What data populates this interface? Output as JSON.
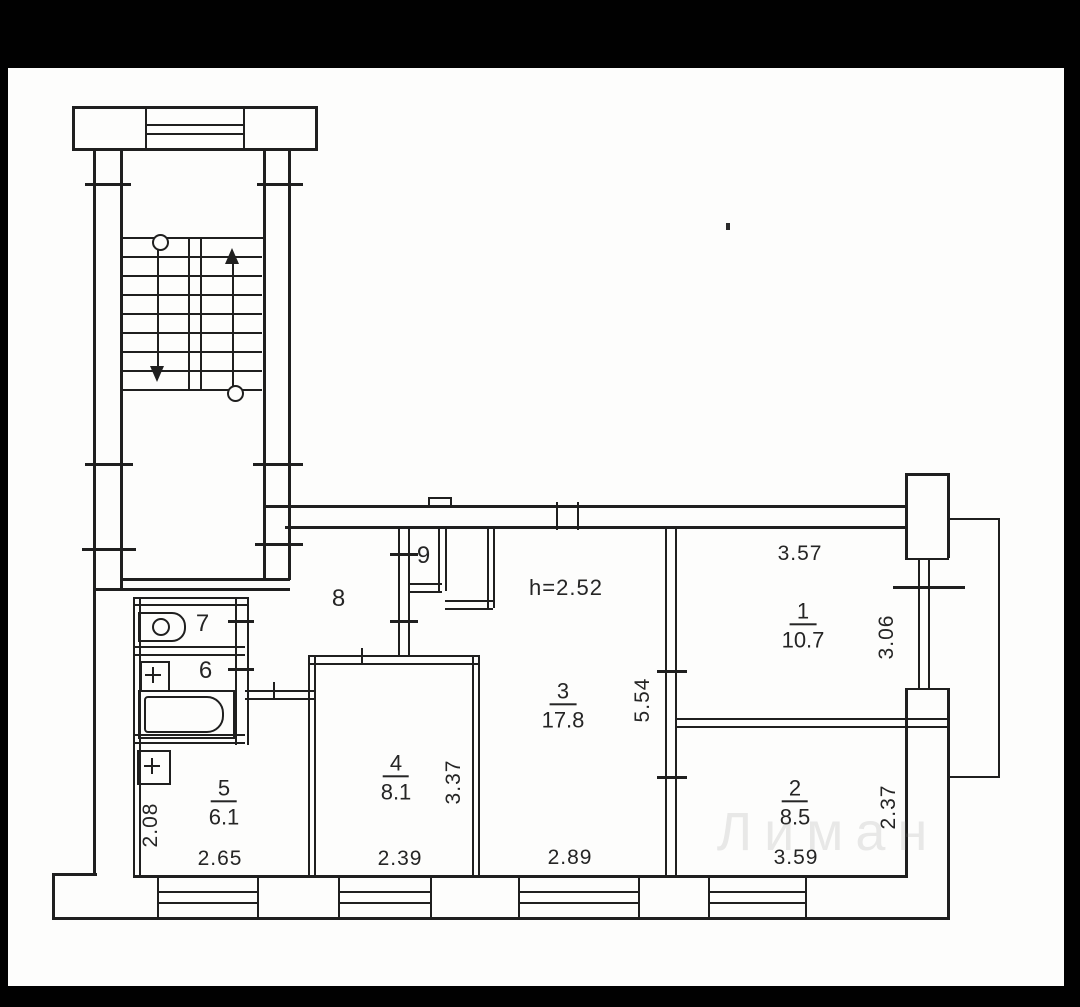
{
  "document": {
    "type": "scanned apartment floor plan",
    "paper_color": "#fdfdfc",
    "frame_color": "#010101",
    "ink_color": "#1f1f1f",
    "ceiling_height_note": "h=2.52",
    "watermark": {
      "text": "Лиман"
    }
  },
  "rooms": [
    {
      "number": "1",
      "area": "10.7",
      "width": "3.57",
      "depth": "3.06",
      "x": 803,
      "y": 626
    },
    {
      "number": "2",
      "area": "8.5",
      "width": "3.59",
      "depth": "2.37",
      "x": 795,
      "y": 803
    },
    {
      "number": "3",
      "area": "17.8",
      "width": "2.89",
      "depth": "5.54",
      "x": 563,
      "y": 706
    },
    {
      "number": "4",
      "area": "8.1",
      "width": "2.39",
      "depth": "3.37",
      "x": 396,
      "y": 778
    },
    {
      "number": "5",
      "area": "6.1",
      "width": "2.65",
      "depth": "2.08",
      "x": 224,
      "y": 803
    }
  ],
  "labels": {
    "dims": [
      {
        "text": "h=2.52",
        "x": 566,
        "y": 588,
        "s": 22
      },
      {
        "text": "3.57",
        "x": 800,
        "y": 554
      },
      {
        "text": "2.65",
        "x": 220,
        "y": 859
      },
      {
        "text": "2.39",
        "x": 400,
        "y": 859
      },
      {
        "text": "2.89",
        "x": 570,
        "y": 858
      },
      {
        "text": "3.59",
        "x": 796,
        "y": 858
      },
      {
        "text": "5.54",
        "x": 643,
        "y": 700,
        "r": 1
      },
      {
        "text": "3.37",
        "x": 454,
        "y": 782,
        "r": 1
      },
      {
        "text": "2.08",
        "x": 151,
        "y": 825,
        "r": 1
      },
      {
        "text": "3.06",
        "x": 887,
        "y": 637,
        "r": 1
      },
      {
        "text": "2.37",
        "x": 889,
        "y": 807,
        "r": 1
      },
      {
        "text": "6",
        "x": 206,
        "y": 671,
        "s": 24
      },
      {
        "text": "7",
        "x": 203,
        "y": 624,
        "s": 24
      },
      {
        "text": "8",
        "x": 339,
        "y": 599,
        "s": 24
      },
      {
        "text": "9",
        "x": 424,
        "y": 556,
        "s": 24
      }
    ]
  },
  "geometry": {
    "h_lines": [
      [
        72,
        106,
        246
      ],
      [
        72,
        148,
        246
      ],
      [
        145,
        124,
        98,
        2
      ],
      [
        145,
        133,
        98,
        2
      ],
      [
        120,
        237,
        143,
        2
      ],
      [
        122,
        389,
        140,
        2
      ],
      [
        120,
        578,
        170
      ],
      [
        93,
        588,
        197
      ],
      [
        263,
        505,
        645
      ],
      [
        285,
        526,
        622
      ],
      [
        133,
        597,
        116,
        2
      ],
      [
        133,
        604,
        116,
        2
      ],
      [
        133,
        646,
        112,
        2
      ],
      [
        133,
        654,
        112,
        2
      ],
      [
        133,
        734,
        112,
        2
      ],
      [
        133,
        742,
        112,
        2
      ],
      [
        245,
        690,
        70,
        2
      ],
      [
        245,
        698,
        70,
        2
      ],
      [
        308,
        655,
        172,
        2
      ],
      [
        308,
        663,
        172,
        2
      ],
      [
        408,
        583,
        34,
        2
      ],
      [
        408,
        591,
        34,
        2
      ],
      [
        445,
        600,
        48,
        2
      ],
      [
        445,
        608,
        48,
        2
      ],
      [
        677,
        718,
        270,
        2
      ],
      [
        677,
        726,
        270,
        2
      ],
      [
        905,
        473,
        45
      ],
      [
        905,
        558,
        44,
        2
      ],
      [
        905,
        688,
        44,
        2
      ],
      [
        947,
        518,
        53,
        2
      ],
      [
        947,
        776,
        53,
        2
      ],
      [
        52,
        873,
        45
      ],
      [
        133,
        875,
        774
      ],
      [
        52,
        917,
        897
      ],
      [
        157,
        891,
        100,
        2
      ],
      [
        157,
        902,
        100,
        2
      ],
      [
        338,
        891,
        92,
        2
      ],
      [
        338,
        902,
        92,
        2
      ],
      [
        518,
        891,
        120,
        2
      ],
      [
        518,
        902,
        120,
        2
      ],
      [
        708,
        891,
        97,
        2
      ],
      [
        708,
        902,
        97,
        2
      ],
      [
        428,
        497,
        24,
        2
      ],
      [
        85,
        183,
        46
      ],
      [
        257,
        183,
        46
      ],
      [
        85,
        463,
        48
      ],
      [
        253,
        463,
        50
      ],
      [
        82,
        548,
        54
      ],
      [
        255,
        543,
        48
      ],
      [
        228,
        620,
        26
      ],
      [
        228,
        668,
        26
      ],
      [
        390,
        553,
        28
      ],
      [
        390,
        620,
        28
      ],
      [
        657,
        670,
        30
      ],
      [
        657,
        776,
        30
      ],
      [
        893,
        586,
        72
      ]
    ],
    "v_lines": [
      [
        72,
        106,
        45
      ],
      [
        315,
        106,
        45
      ],
      [
        145,
        106,
        42,
        2
      ],
      [
        243,
        106,
        42,
        2
      ],
      [
        93,
        148,
        727
      ],
      [
        120,
        148,
        442
      ],
      [
        263,
        148,
        432
      ],
      [
        288,
        148,
        432
      ],
      [
        188,
        237,
        152,
        2
      ],
      [
        200,
        237,
        152,
        2
      ],
      [
        157,
        246,
        120,
        2
      ],
      [
        232,
        262,
        124,
        2
      ],
      [
        133,
        597,
        281,
        2
      ],
      [
        139,
        597,
        281,
        2
      ],
      [
        235,
        597,
        148,
        2
      ],
      [
        247,
        597,
        148,
        2
      ],
      [
        308,
        655,
        222,
        2
      ],
      [
        314,
        655,
        222,
        2
      ],
      [
        472,
        655,
        222,
        2
      ],
      [
        478,
        655,
        222,
        2
      ],
      [
        398,
        526,
        131,
        2
      ],
      [
        408,
        526,
        131,
        2
      ],
      [
        438,
        528,
        63,
        2
      ],
      [
        445,
        528,
        63,
        2
      ],
      [
        487,
        528,
        80,
        2
      ],
      [
        493,
        528,
        80,
        2
      ],
      [
        665,
        528,
        349,
        2
      ],
      [
        675,
        528,
        349,
        2
      ],
      [
        905,
        473,
        87
      ],
      [
        947,
        473,
        85
      ],
      [
        918,
        558,
        132,
        2
      ],
      [
        928,
        558,
        132,
        2
      ],
      [
        905,
        688,
        190
      ],
      [
        947,
        688,
        232
      ],
      [
        998,
        518,
        260,
        2
      ],
      [
        52,
        873,
        47
      ],
      [
        157,
        877,
        42,
        2
      ],
      [
        257,
        877,
        42,
        2
      ],
      [
        338,
        877,
        42,
        2
      ],
      [
        430,
        877,
        42,
        2
      ],
      [
        518,
        877,
        42,
        2
      ],
      [
        638,
        877,
        42,
        2
      ],
      [
        708,
        877,
        42,
        2
      ],
      [
        805,
        877,
        42,
        2
      ],
      [
        428,
        497,
        10,
        2
      ],
      [
        450,
        497,
        10,
        2
      ],
      [
        361,
        648,
        17,
        2
      ],
      [
        273,
        682,
        18,
        2
      ],
      [
        556,
        502,
        28,
        2
      ],
      [
        577,
        502,
        28,
        2
      ]
    ],
    "treads": {
      "x": 122,
      "w": 140,
      "ys": [
        256,
        275,
        294,
        313,
        332,
        351,
        370
      ]
    },
    "boxes": [
      {
        "x": 138,
        "y": 612,
        "w": 44,
        "h": 26,
        "r": "0 14px 14px 0",
        "n": "toilet-fixture"
      },
      {
        "x": 138,
        "y": 690,
        "w": 93,
        "h": 45,
        "n": "bathtub-outer"
      },
      {
        "x": 144,
        "y": 696,
        "w": 76,
        "h": 33,
        "r": "4px 17px 17px 4px",
        "n": "bathtub"
      },
      {
        "x": 140,
        "y": 661,
        "w": 26,
        "h": 27,
        "n": "sink-fixture"
      },
      {
        "x": 137,
        "y": 750,
        "w": 30,
        "h": 31,
        "n": "vent-shaft"
      }
    ],
    "circles": [
      {
        "x": 152,
        "y": 618,
        "d": 14,
        "n": "toilet-bowl-circle"
      },
      {
        "x": 152,
        "y": 234,
        "d": 13,
        "n": "stair-start-marker"
      },
      {
        "x": 227,
        "y": 385,
        "d": 13,
        "n": "stair-start-marker"
      }
    ],
    "plus_marks": [
      {
        "cx": 153,
        "cy": 675
      },
      {
        "cx": 152,
        "cy": 766
      }
    ],
    "arrows": [
      {
        "x": 150,
        "y": 366,
        "dir": "down"
      },
      {
        "x": 225,
        "y": 248,
        "dir": "up"
      }
    ],
    "specks": [
      {
        "x": 726,
        "y": 223,
        "w": 4,
        "h": 7
      }
    ]
  }
}
